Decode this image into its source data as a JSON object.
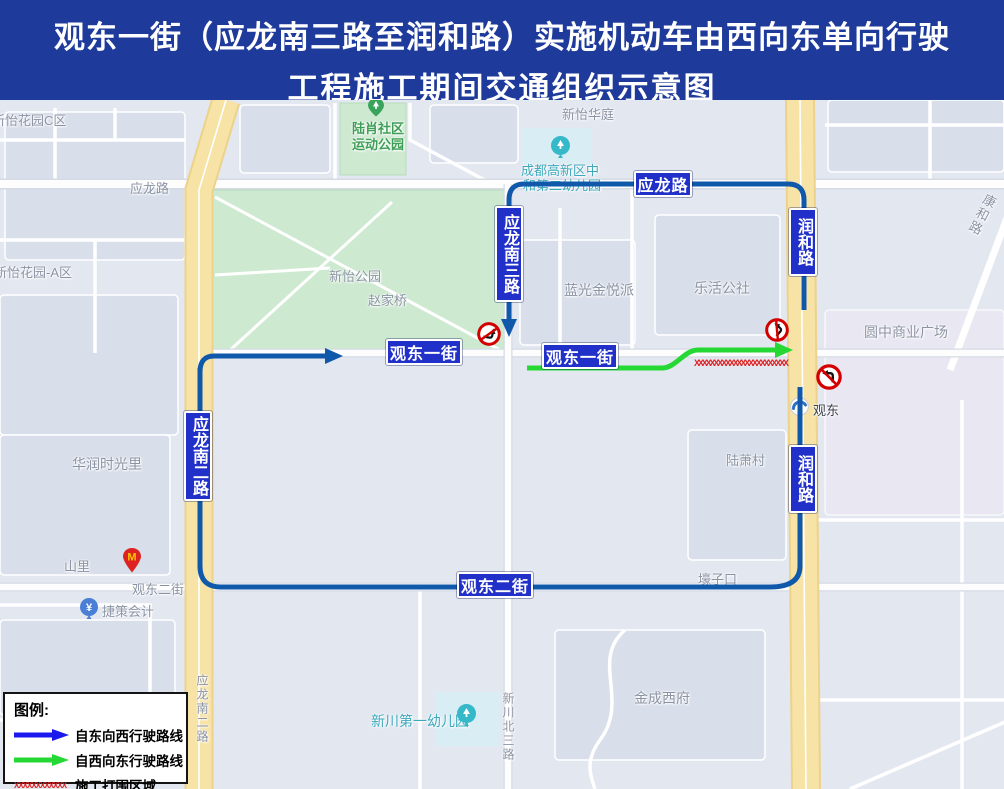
{
  "title": {
    "line1": "观东一街（应龙南三路至润和路）实施机动车由西向东单向行驶",
    "line2": "工程施工期间交通组织示意图"
  },
  "legend": {
    "title": "图例:",
    "east_to_west": "自东向西行驶路线",
    "west_to_east": "自西向东行驶路线",
    "construction": "施工打围区域",
    "hatch_sample": "XXXXXXXXXXXX"
  },
  "road_badges": {
    "yinglong_rd": "应龙路",
    "yinglong_s3": "应龙南三路",
    "runhe_n": "润和路",
    "runhe_s": "润和路",
    "yinglong_s2": "应龙南二路",
    "guandong1_w": "观东一街",
    "guandong1_e": "观东一街",
    "guandong2": "观东二街"
  },
  "map_labels": {
    "xinyi_c": "新怡花园C区",
    "yinglong_gray": "应龙路",
    "xinyi_a": "新怡花园-A区",
    "xinyi_huating": "新怡华庭",
    "luxiao_park_l1": "陆肖社区",
    "luxiao_park_l2": "运动公园",
    "kindergarten2_l1": "成都高新区中",
    "kindergarten2_l2": "和第二幼儿园",
    "xinyi_park": "新怡公园",
    "zhaojiaqiao": "赵家桥",
    "languang": "蓝光金悦派",
    "lehuo": "乐活公社",
    "yuanzhong": "圆中商业广场",
    "kanghe": "康和路",
    "huarun": "华润时光里",
    "shanli": "山里",
    "guandong2_gray": "观东二街",
    "jiece": "捷策会计",
    "luxiao_village": "陆萧村",
    "haozikou": "壕子口",
    "xinchuan_kg": "新川第一幼儿园",
    "xinchuan_n3": "新川北三路",
    "jincheng": "金成西府",
    "yinglong_s2_gray": "应龙南二路",
    "guandong_station": "观东",
    "mcdonalds": "M",
    "yuan": "¥"
  },
  "construction_hatch": "XXXXXXXXXXXXXXXXXXXXXXXX",
  "colors": {
    "title_bg": "#1e3a9a",
    "badge_bg": "#2130c8",
    "route_east_to_west": "#0f58aa",
    "route_west_to_east": "#25d833",
    "construction": "#e02020"
  }
}
